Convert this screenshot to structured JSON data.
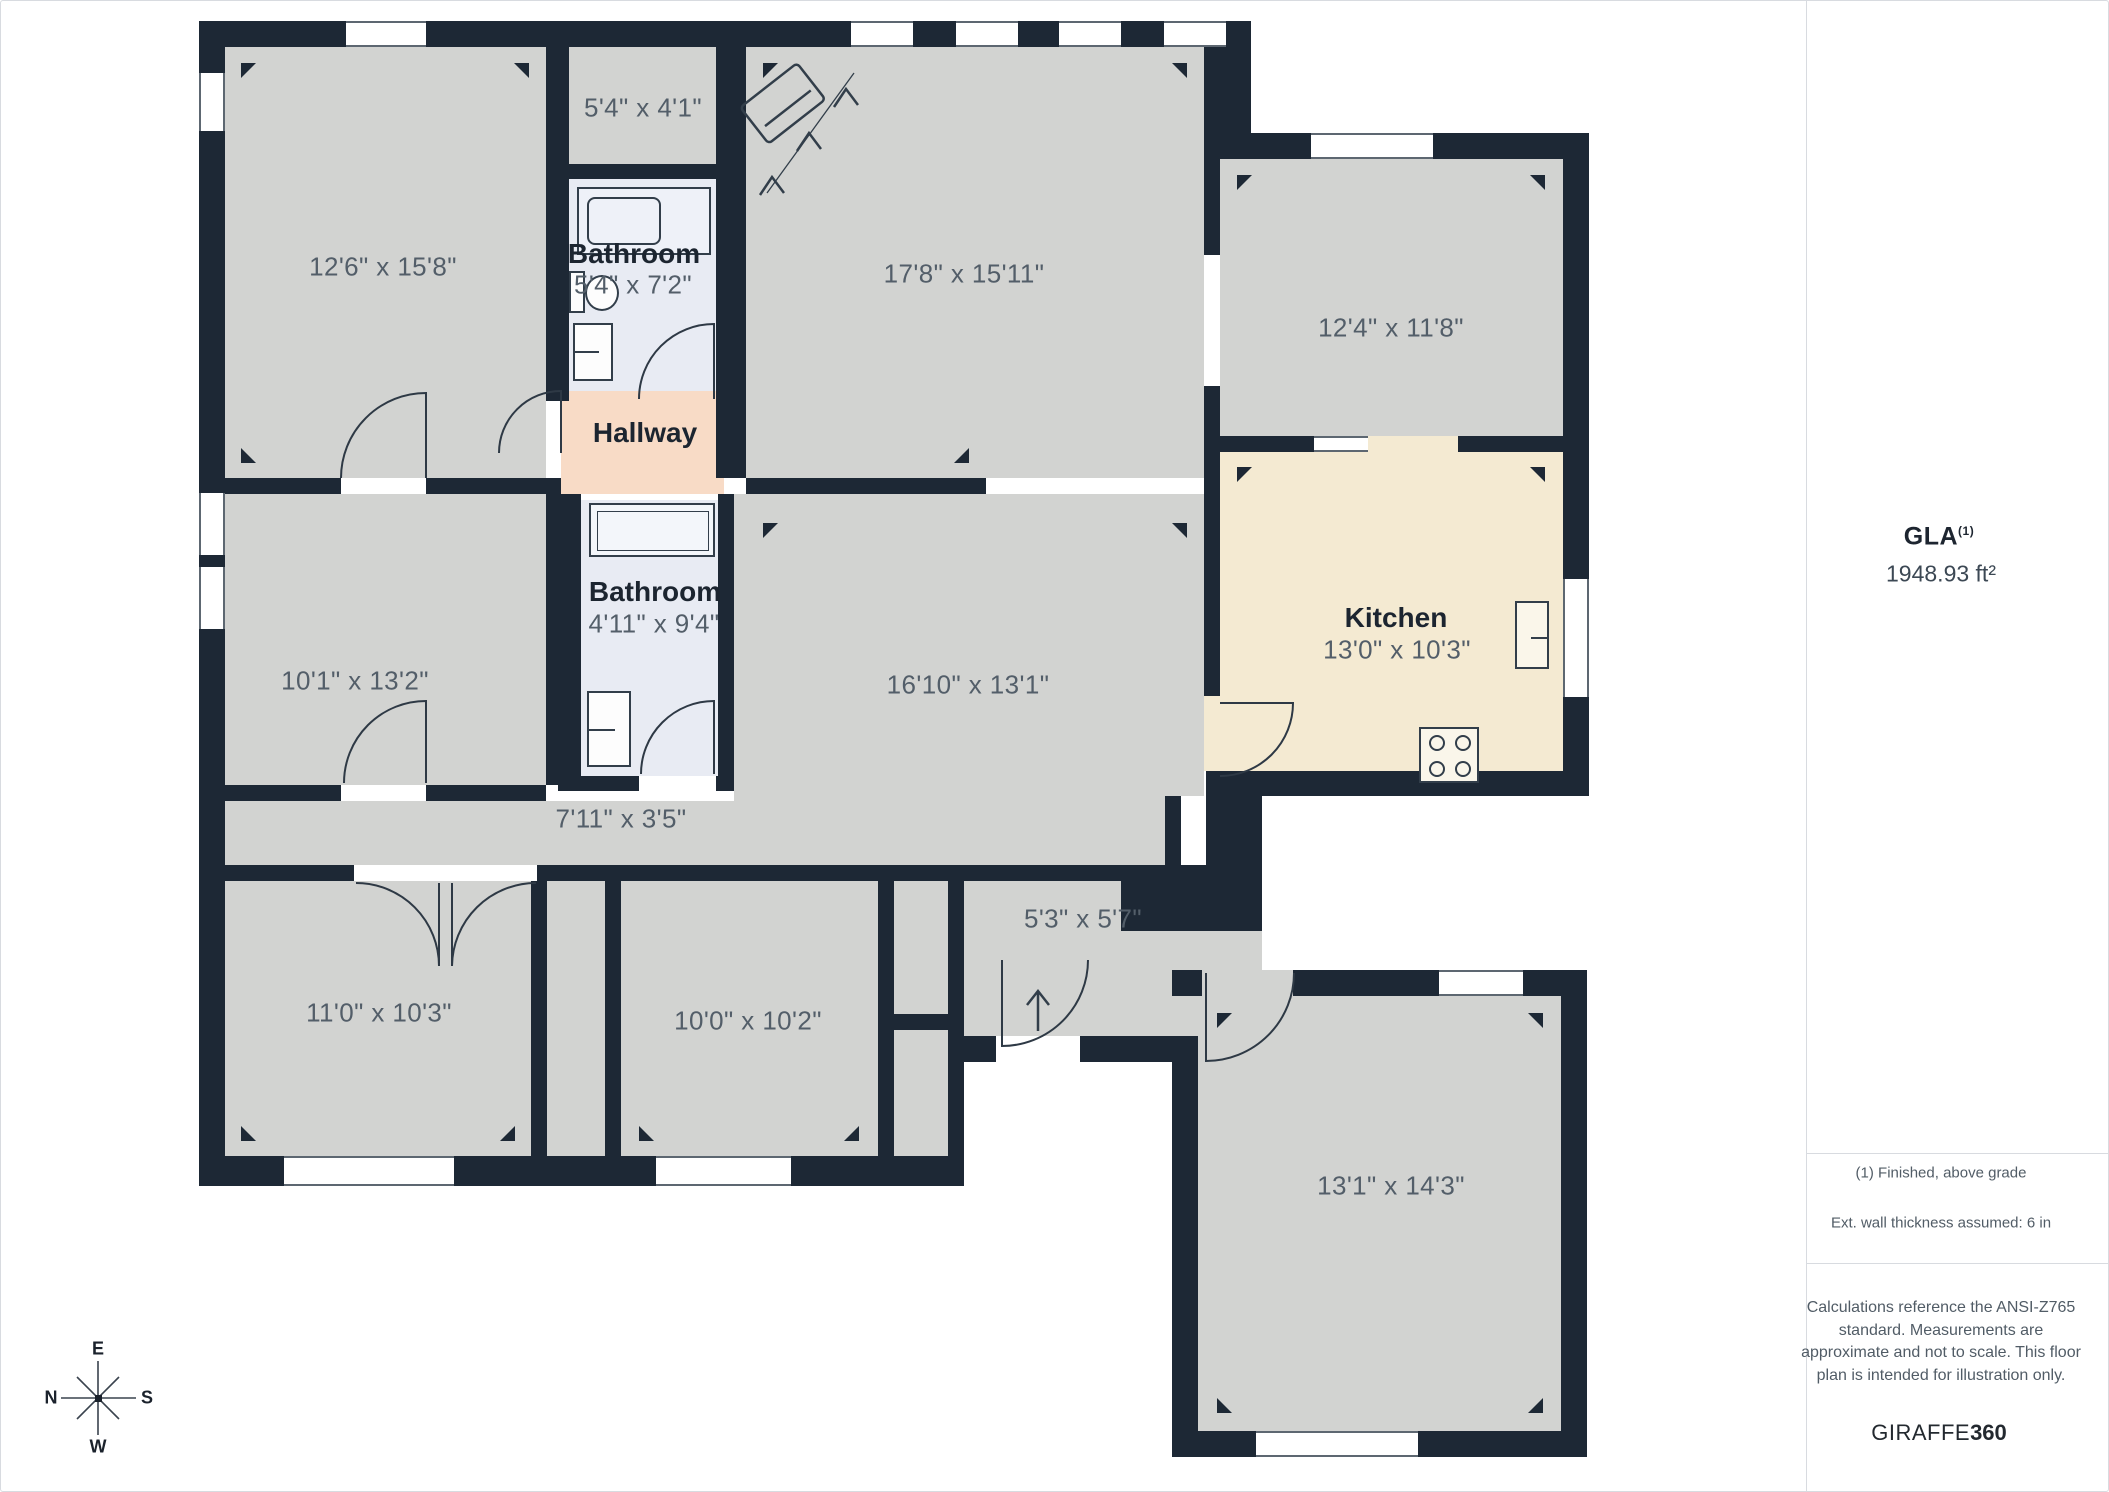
{
  "plan": {
    "rooms": [
      {
        "dims": "12'6\" x 15'8\""
      },
      {
        "dims": "5'4\" x 4'1\""
      },
      {
        "name": "Bathroom",
        "dims": "5'4\" x 7'2\""
      },
      {
        "dims": "17'8\" x 15'11\""
      },
      {
        "dims": "12'4\" x 11'8\""
      },
      {
        "name": "Hallway"
      },
      {
        "name": "Bathroom",
        "dims": "4'11\" x 9'4\""
      },
      {
        "dims": "10'1\" x 13'2\""
      },
      {
        "dims": "16'10\" x 13'1\""
      },
      {
        "name": "Kitchen",
        "dims": "13'0\" x 10'3\""
      },
      {
        "dims": "7'11\" x 3'5\""
      },
      {
        "dims": "11'0\" x 10'3\""
      },
      {
        "dims": "10'0\" x 10'2\""
      },
      {
        "dims": "5'3\" x 5'7\""
      },
      {
        "dims": "13'1\" x 14'3\""
      }
    ],
    "colors": {
      "wall": "#1d2835",
      "room_fill": "#d2d3d1",
      "bathroom_fill": "#e8ebf3",
      "hallway_fill": "#f8dbc6",
      "kitchen_fill": "#f4ead2",
      "dims_text": "#535e69",
      "name_text": "#1c2530"
    }
  },
  "compass": {
    "top": "E",
    "right": "S",
    "bottom": "W",
    "left": "N"
  },
  "sidebar": {
    "gla_label": "GLA",
    "gla_note_ref": "(1)",
    "gla_value": "1948.93 ft²",
    "notes": [
      "(1) Finished, above grade",
      "Ext. wall thickness assumed: 6 in"
    ],
    "disclaimer": "Calculations reference the ANSI-Z765 standard. Measurements are approximate and not to scale. This floor plan is intended for illustration only.",
    "brand_name": "GIRAFFE",
    "brand_suffix": "360"
  }
}
